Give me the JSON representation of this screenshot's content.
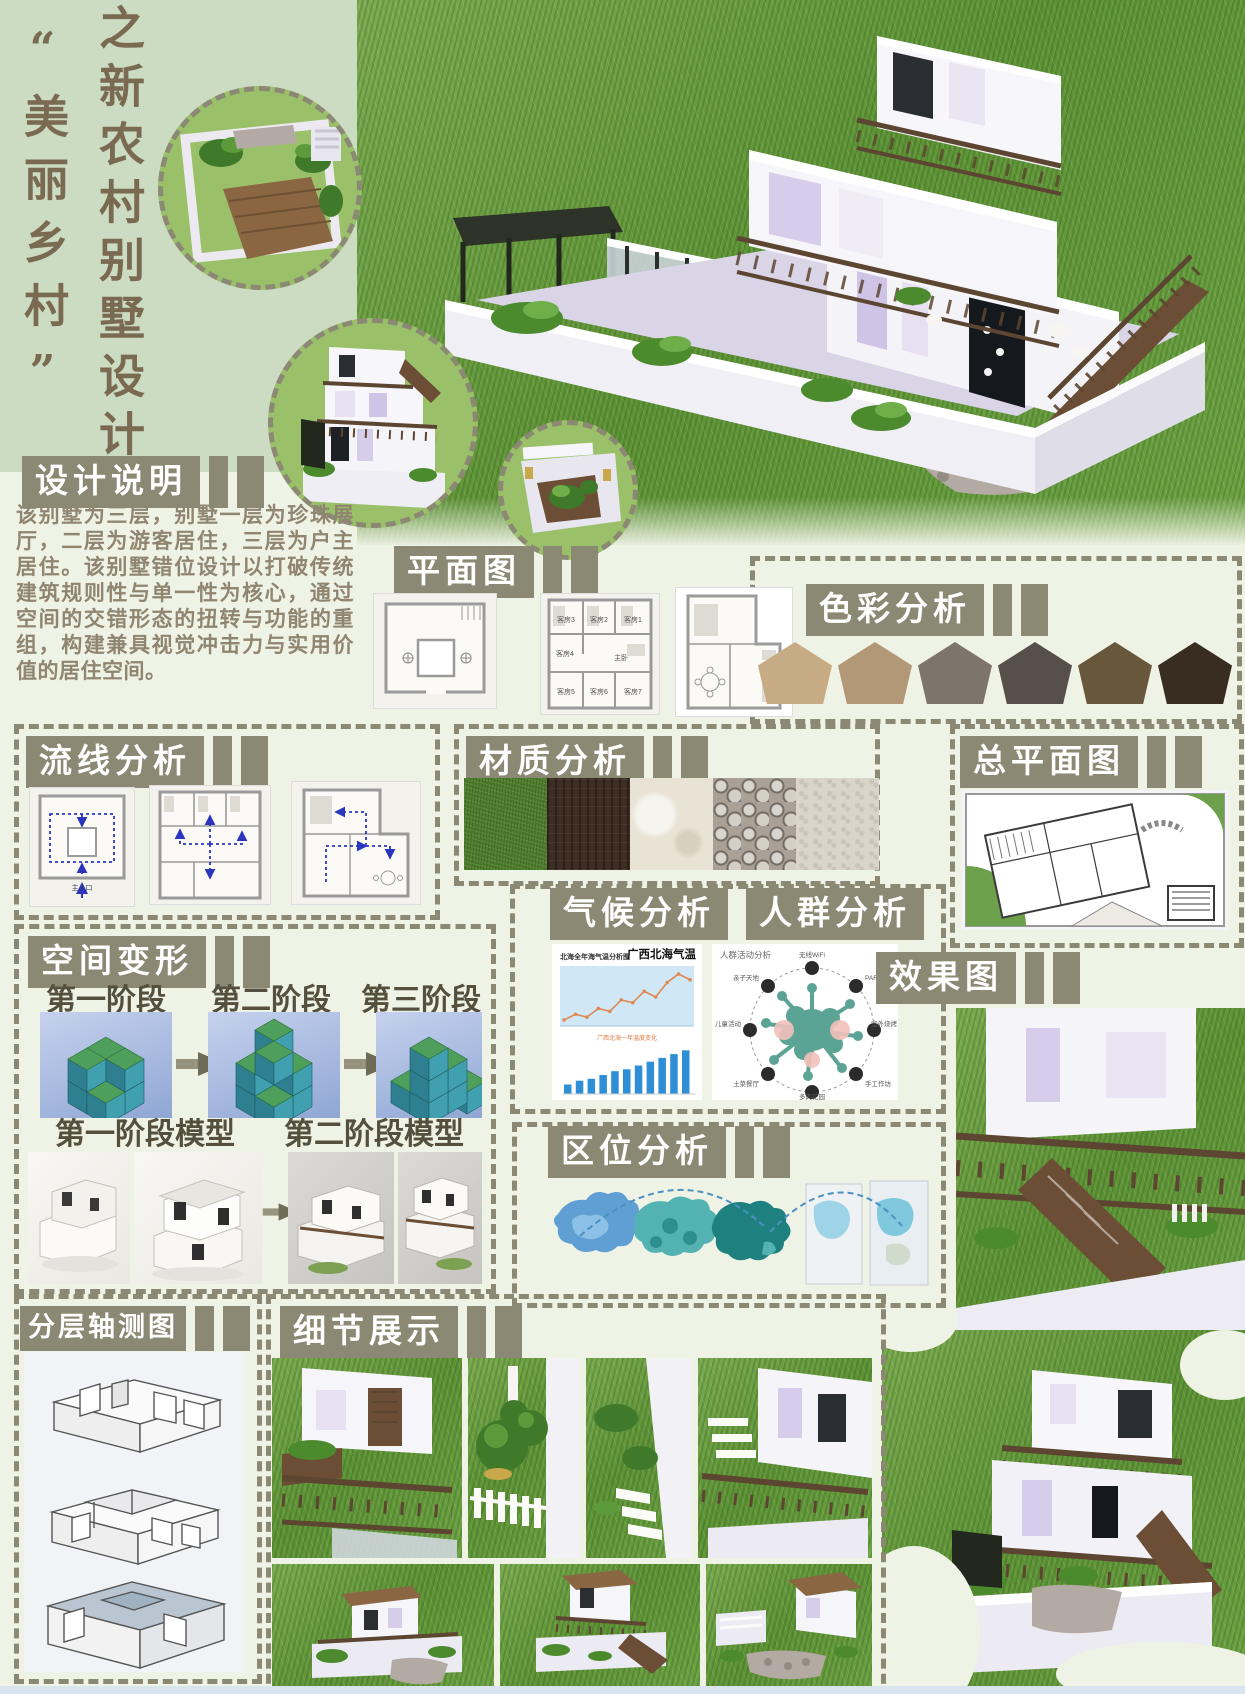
{
  "poster": {
    "series_title": "之新农村别墅设计",
    "theme_title": "“美丽乡村”"
  },
  "colors": {
    "accent_olive": "#8b8873",
    "left_panel_green": "#ccdcc2",
    "page_bg": "#eff3e5",
    "title_brown": "#7a6a52",
    "body_text": "#8f8570",
    "flow_arrow_blue": "#2b36c0",
    "footer_blue": "#d8e5f1"
  },
  "sections": {
    "design_notes": {
      "title": "设计说明",
      "body": "该别墅为三层，别墅一层为珍珠展厅，二层为游客居住，三层为户主居住。该别墅错位设计以打破传统建筑规则性与单一性为核心，通过空间的交错形态的扭转与功能的重组，构建兼具视觉冲击力与实用价值的居住空间。"
    },
    "floor_plan": {
      "title": "平面图",
      "room_labels": [
        "客房3",
        "客房2",
        "客房1",
        "客房4",
        "主卧",
        "客房5",
        "客房6",
        "客房7"
      ]
    },
    "color_analysis": {
      "title": "色彩分析",
      "swatches": [
        "#c6ab85",
        "#b39878",
        "#7d7569",
        "#57504a",
        "#68573b",
        "#382d20"
      ]
    },
    "circulation": {
      "title": "流线分析",
      "entrance_label": "主入口"
    },
    "material": {
      "title": "材质分析",
      "swatches": [
        "#4f7d2b",
        "#3e2d22",
        "#e9e3d5",
        "#a9a195",
        "#d9d5c9"
      ]
    },
    "site_plan": {
      "title": "总平面图"
    },
    "climate": {
      "title": "气候分析"
    },
    "crowd": {
      "title": "人群分析",
      "diagram_title": "人群活动分析",
      "labels": [
        "无线WiFi",
        "PARTY聚会",
        "室外烧烤",
        "手工作坊",
        "多肉花园",
        "土菜餐厅",
        "儿童活动",
        "亲子天地"
      ]
    },
    "space_transform": {
      "title": "空间变形",
      "stage_labels": [
        "第一阶段",
        "第二阶段",
        "第三阶段"
      ],
      "model_labels": [
        "第一阶段模型",
        "第二阶段模型"
      ]
    },
    "render": {
      "title": "效果图"
    },
    "location": {
      "title": "区位分析"
    },
    "axonometric": {
      "title": "分层轴测图"
    },
    "details": {
      "title": "细节展示"
    }
  },
  "chart_data": [
    {
      "type": "line",
      "title": "广西北海气温",
      "subtitle": "北海全年海气温分析图",
      "legend": "广西北海一年温度变化",
      "x": [
        1,
        2,
        3,
        4,
        5,
        6,
        7,
        8,
        9,
        10,
        11,
        12
      ],
      "values": [
        13,
        15,
        14,
        17,
        16,
        20,
        19,
        23,
        21,
        26,
        29,
        27
      ],
      "line_color": "#e08850",
      "plot_bg": "#cfe7f7"
    },
    {
      "type": "bar",
      "values": [
        5,
        7,
        8,
        10,
        12,
        13,
        15,
        17,
        19,
        21,
        23
      ],
      "bar_color": "#2f8fd6"
    }
  ]
}
